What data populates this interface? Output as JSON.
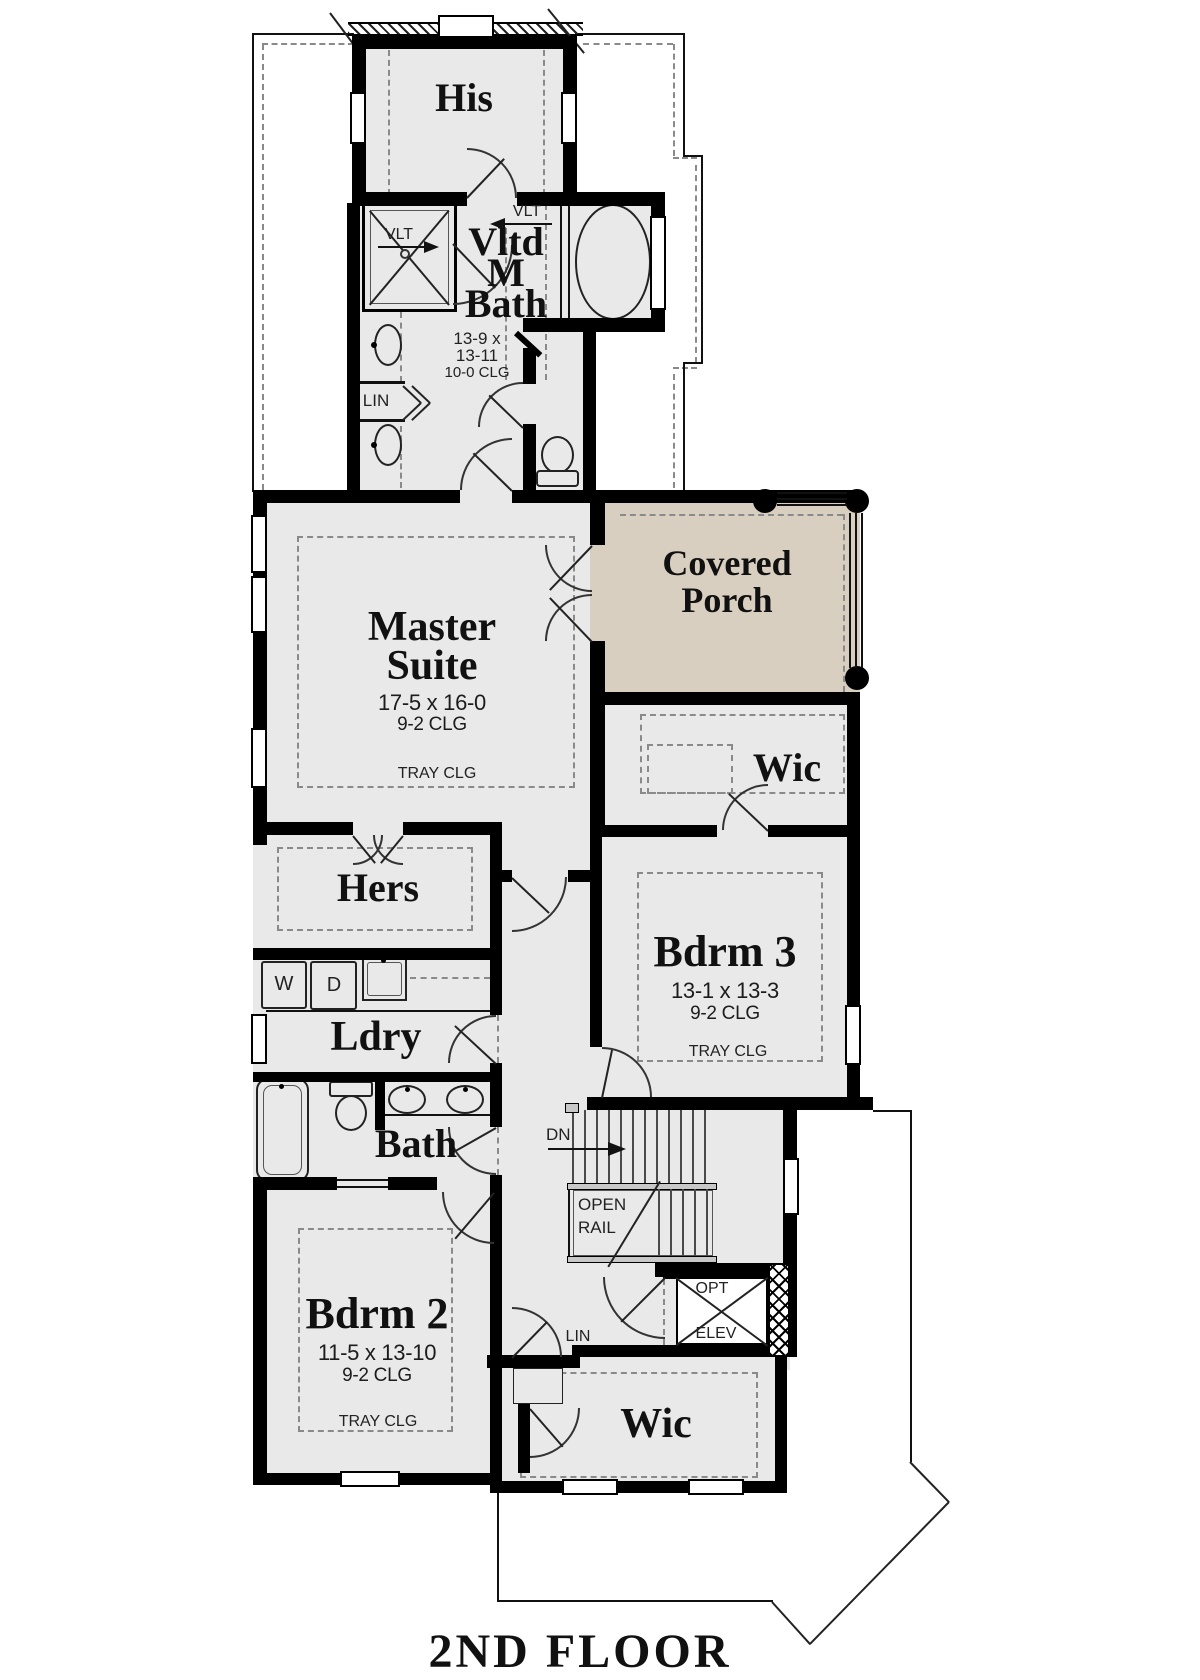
{
  "title": "2ND FLOOR",
  "colors": {
    "wall": "#000000",
    "room_fill": "#e9e9e9",
    "porch_fill": "#d9cfc1",
    "dash": "#8a8a8a",
    "paper": "#ffffff"
  },
  "rooms": {
    "his_closet": {
      "name": "His"
    },
    "master_bath": {
      "name_l1": "Vltd",
      "name_l2": "M",
      "name_l3": "Bath",
      "dim_l1": "13-9 x",
      "dim_l2": "13-11",
      "ceiling": "10-0 CLG",
      "shower_label": "VLT",
      "vault_label": "VLT",
      "linen": "LIN"
    },
    "master_suite": {
      "name_l1": "Master",
      "name_l2": "Suite",
      "dim": "17-5 x 16-0",
      "ceiling": "9-2 CLG",
      "tray": "TRAY CLG"
    },
    "covered_porch": {
      "name_l1": "Covered",
      "name_l2": "Porch"
    },
    "wic_master": {
      "name": "Wic"
    },
    "hers_closet": {
      "name": "Hers"
    },
    "laundry": {
      "name": "Ldry",
      "washer": "W",
      "dryer": "D"
    },
    "bath": {
      "name": "Bath"
    },
    "bedroom3": {
      "name": "Bdrm 3",
      "dim": "13-1 x 13-3",
      "ceiling": "9-2 CLG",
      "tray": "TRAY CLG"
    },
    "bedroom2": {
      "name": "Bdrm 2",
      "dim": "11-5 x 13-10",
      "ceiling": "9-2 CLG",
      "tray": "TRAY CLG"
    },
    "wic_bedroom2": {
      "name": "Wic"
    },
    "hall_linen": {
      "name": "LIN"
    },
    "stairs": {
      "down": "DN",
      "open_rail_l1": "OPEN",
      "open_rail_l2": "RAIL"
    },
    "elevator": {
      "opt": "OPT",
      "elev": "ELEV"
    }
  }
}
